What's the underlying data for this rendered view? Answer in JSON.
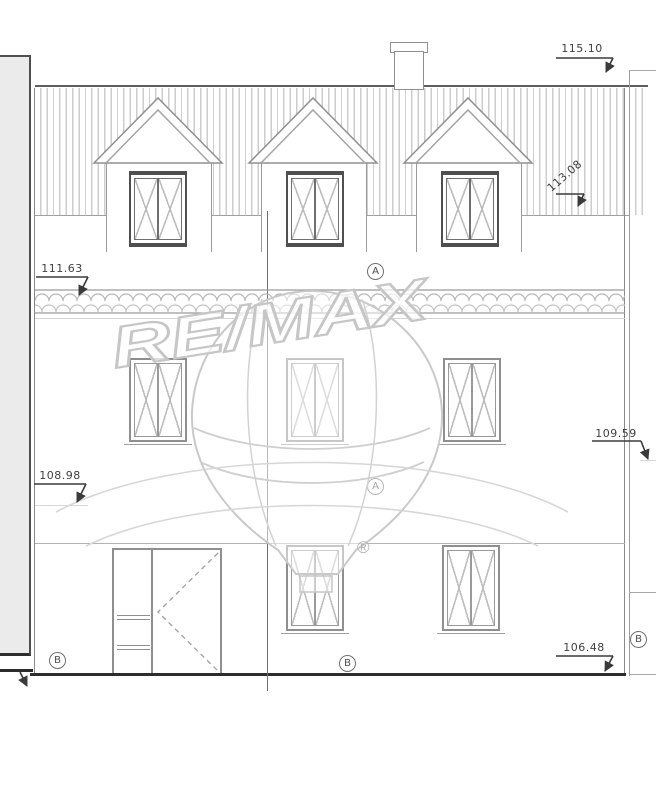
{
  "watermark": {
    "brand": "RE/MAX",
    "registered_mark": "®"
  },
  "dimensions": {
    "ridge": "115.10",
    "right_eaves": "113.08",
    "left_cornice": "111.63",
    "left_level": "108.98",
    "right_level": "109.59",
    "street_level": "106.48"
  },
  "markers": {
    "axis_a_upper": "A",
    "axis_a_lower": "A",
    "axis_b_left": "B",
    "axis_b_center": "B",
    "axis_b_right": "B"
  },
  "colors": {
    "line": "#9a9a9a",
    "dark_line": "#3a3a3a",
    "roof_stripe": "#cdcdcd",
    "ground": "#2c2c2c",
    "neighbor_fill": "#ebebeb",
    "section_line": "#5c7878",
    "watermark": "#c9c9c9",
    "dim_text": "#3f3f3f"
  }
}
